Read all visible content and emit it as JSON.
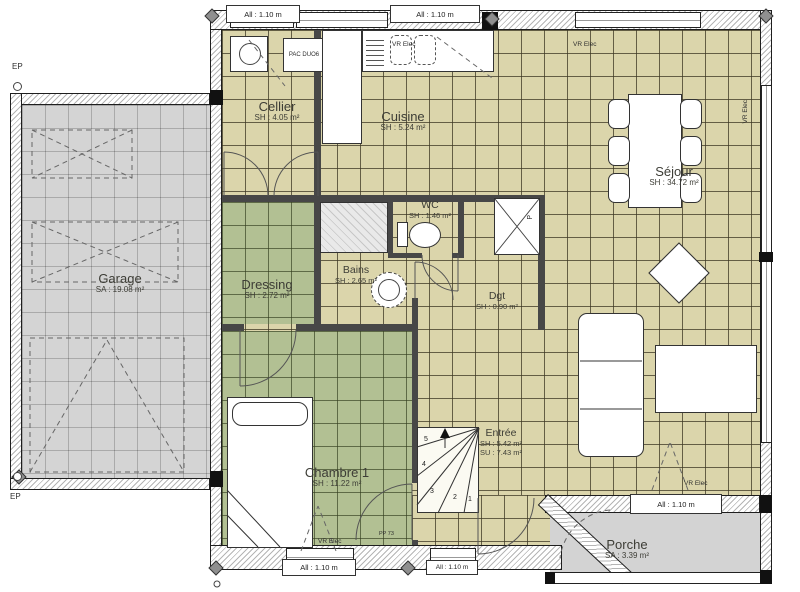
{
  "rooms": {
    "garage": {
      "name": "Garage",
      "area": "SA : 19.08 m²"
    },
    "cellier": {
      "name": "Cellier",
      "area": "SH : 4.05 m²"
    },
    "cuisine": {
      "name": "Cuisine",
      "area": "SH : 5.24 m²"
    },
    "sejour": {
      "name": "Séjour",
      "area": "SH : 34.72 m²"
    },
    "wc": {
      "name": "WC",
      "area": "SH : 1.46 m²"
    },
    "bains": {
      "name": "Bains",
      "area": "SH : 2.65 m²"
    },
    "dressing": {
      "name": "Dressing",
      "area": "SH : 2.72 m²"
    },
    "dgt": {
      "name": "Dgt",
      "area": "SH : 0.90 m²"
    },
    "chambre": {
      "name": "Chambre 1",
      "area": "SH : 11.22 m²"
    },
    "entree": {
      "name": "Entrée",
      "area": "SH : 5.42 m²",
      "area2": "SU : 7.43 m²"
    },
    "porche": {
      "name": "Porche",
      "area": "SA : 3.39 m²"
    }
  },
  "labels": {
    "window": "All : 1.10 m",
    "vr_elec": "VR Elec",
    "pac": "PAC DUO6",
    "pp73": "PP 73",
    "ep": "EP",
    "p": "P"
  },
  "stairs": {
    "n1": "1",
    "n2": "2",
    "n3": "3",
    "n4": "4",
    "n5": "5"
  },
  "colors": {
    "tile_beige": "#dbd5ab",
    "tile_green": "#b2c093",
    "garage_gray": "#d4d4d4",
    "porch_gray": "#d3d3d3"
  }
}
